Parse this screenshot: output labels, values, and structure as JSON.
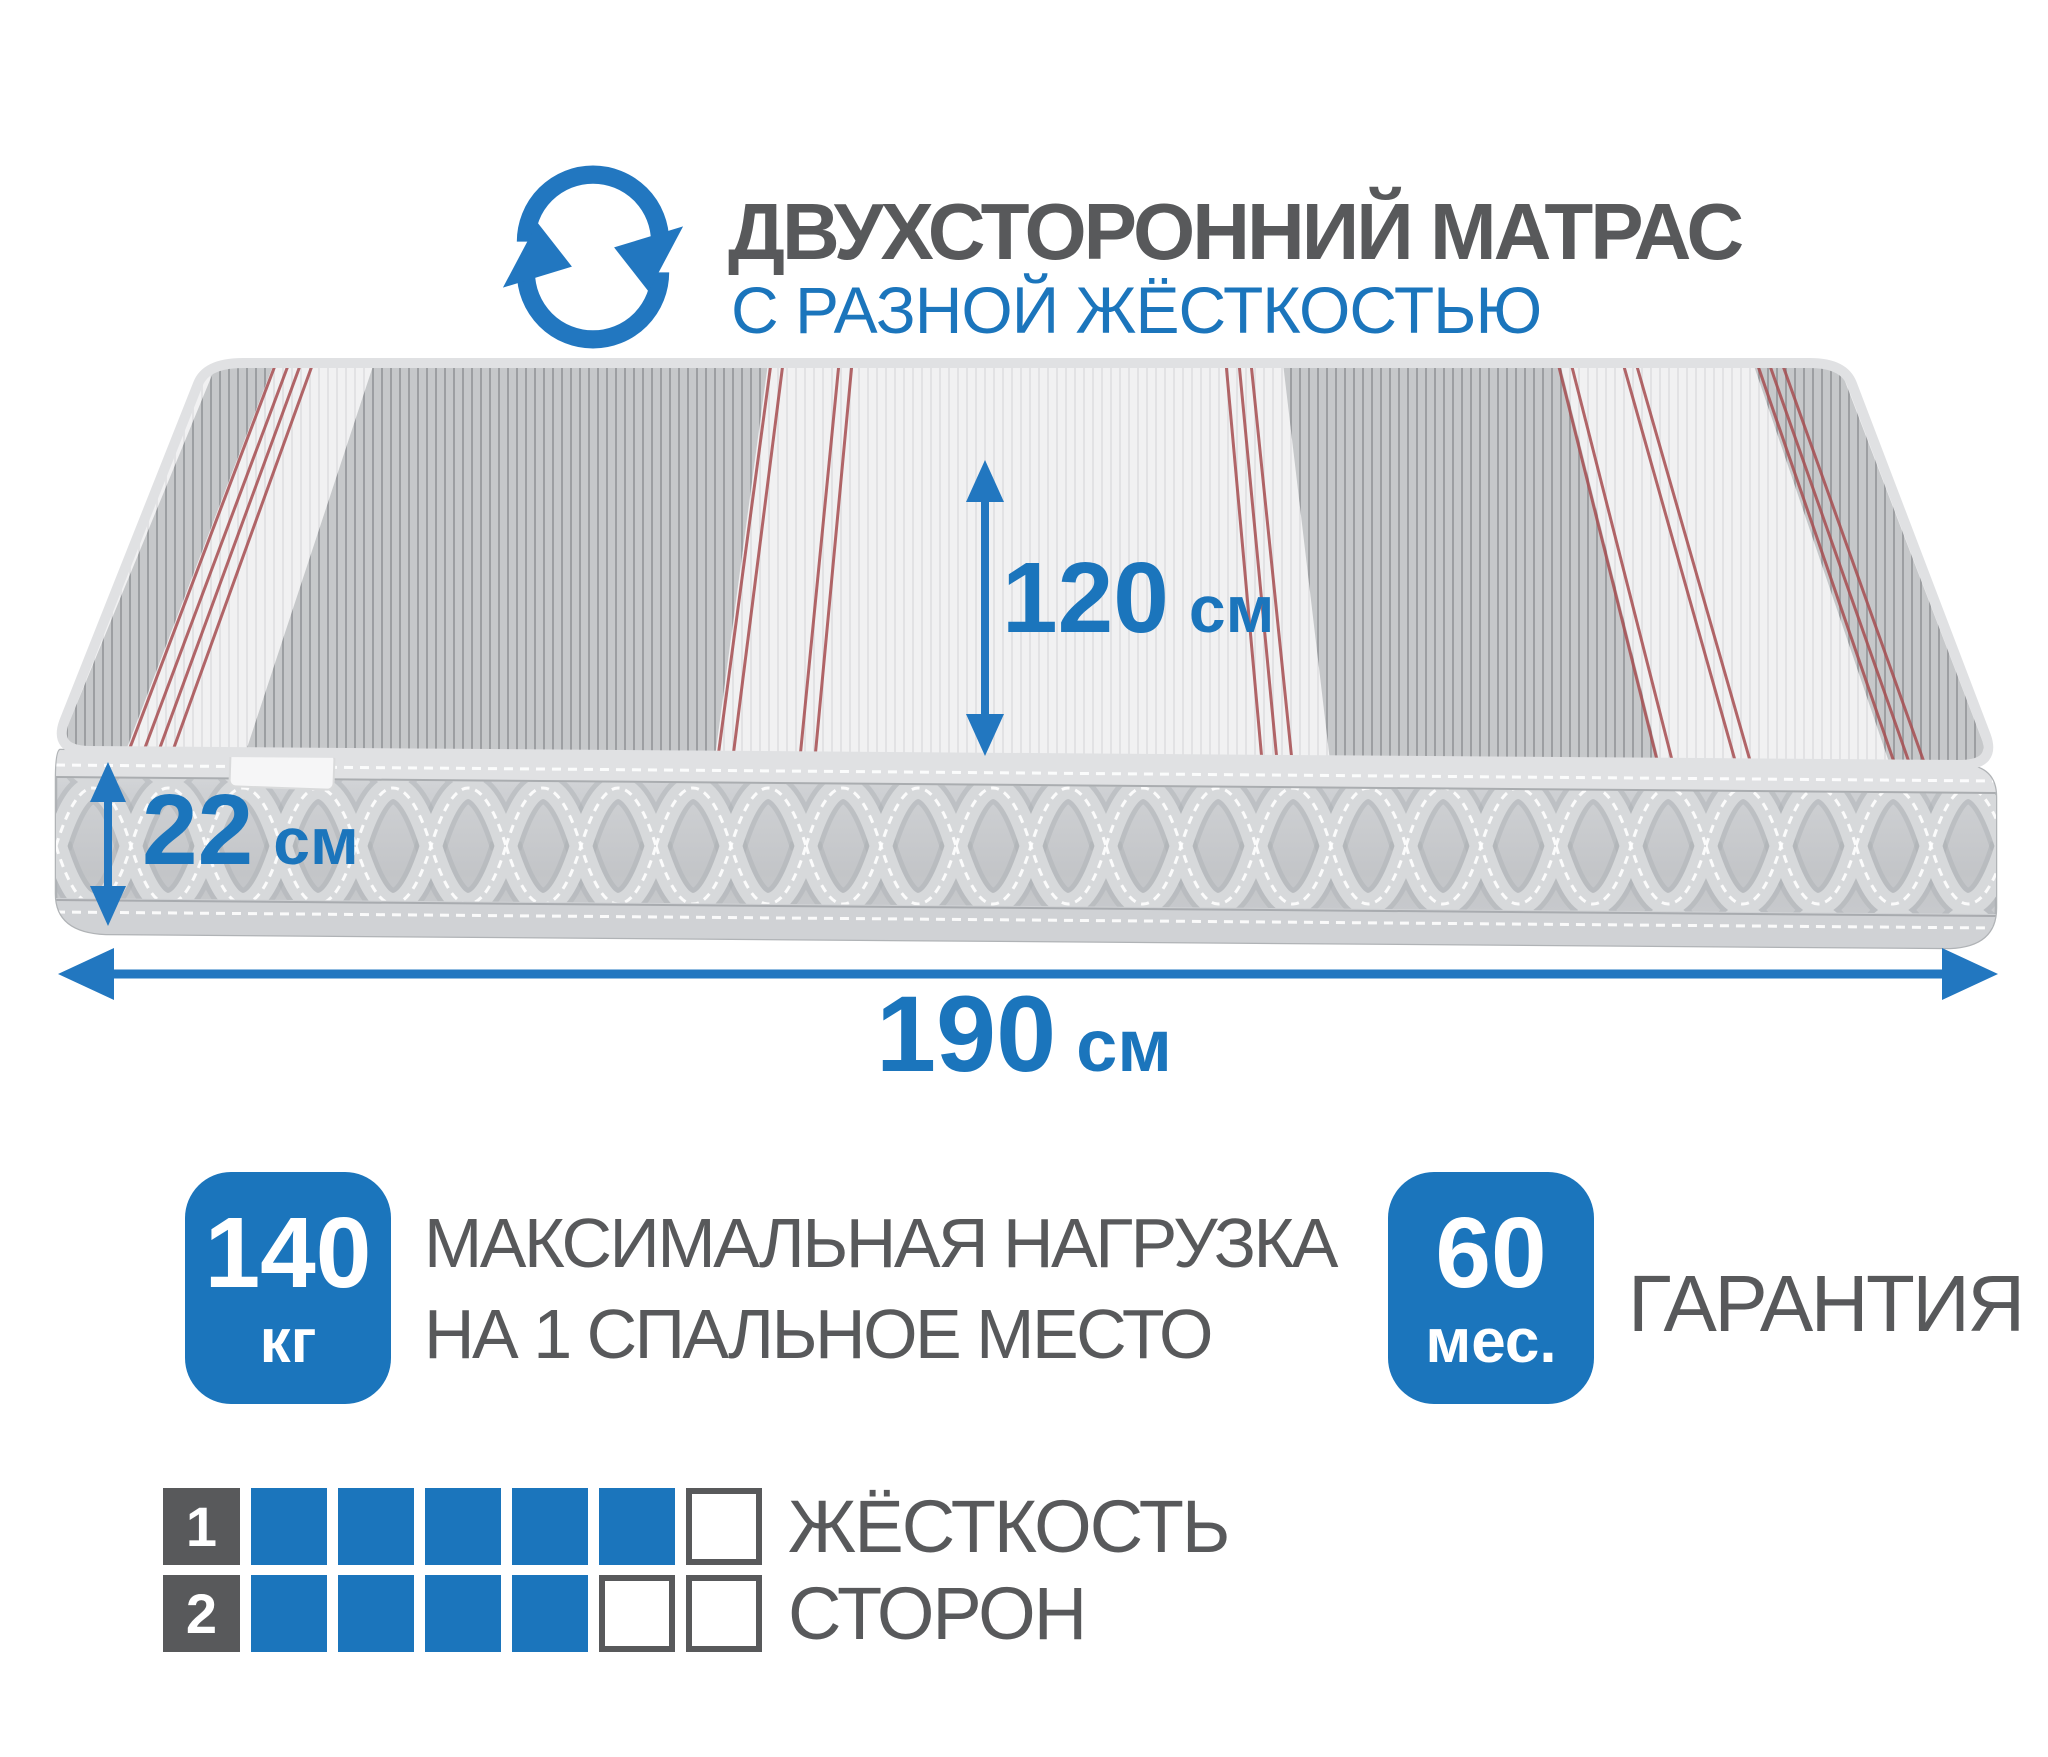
{
  "colors": {
    "blue": "#1b75bc",
    "arrow_blue": "#2277c0",
    "dark_gray": "#58595b",
    "red_stripe": "#a64d50"
  },
  "header": {
    "title": "ДВУХСТОРОННИЙ МАТРАС",
    "subtitle": "С РАЗНОЙ ЖЁСТКОСТЬЮ",
    "icon": "rotate-arrows-icon"
  },
  "dimensions": {
    "width": {
      "value": "120",
      "unit": "см"
    },
    "height": {
      "value": "22",
      "unit": "см"
    },
    "length": {
      "value": "190",
      "unit": "см"
    }
  },
  "badges": {
    "max_load": {
      "value": "140",
      "unit": "кг",
      "label_line1": "МАКСИМАЛЬНАЯ НАГРУЗКА",
      "label_line2": "НА 1 СПАЛЬНОЕ МЕСТО"
    },
    "warranty": {
      "value": "60",
      "unit": "мес.",
      "label": "ГАРАНТИЯ"
    }
  },
  "hardness": {
    "label_line1": "ЖЁСТКОСТЬ",
    "label_line2": "СТОРОН",
    "rows": [
      {
        "index": "1",
        "filled": 5,
        "total": 6
      },
      {
        "index": "2",
        "filled": 4,
        "total": 6
      }
    ]
  }
}
